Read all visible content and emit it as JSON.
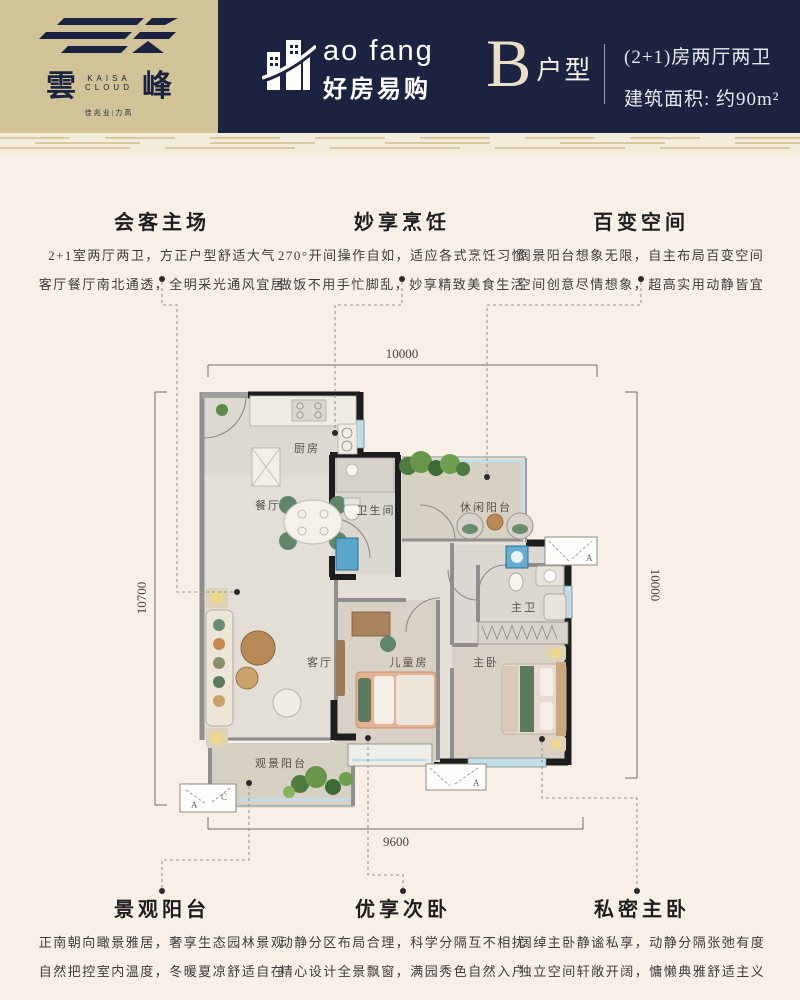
{
  "header": {
    "brand": {
      "hanzi_left": "雲",
      "hanzi_right": "峰",
      "en_top": "KAISA",
      "en_bottom": "CLOUD",
      "subtitle": "佳兆业|力高"
    },
    "platform": {
      "en": "ao fang",
      "zh": "好房易购"
    },
    "unit": {
      "letter": "B",
      "suffix": "户型"
    },
    "spec": {
      "line1": "(2+1)房两厅两卫",
      "line2": "建筑面积: 约90m²"
    }
  },
  "features_top": [
    {
      "title": "会客主场",
      "line1": "2+1室两厅两卫，方正户型舒适大气",
      "line2": "客厅餐厅南北通透，全明采光通风宜居"
    },
    {
      "title": "妙享烹饪",
      "line1": "270°开间操作自如，适应各式烹饪习惯",
      "line2": "做饭不用手忙脚乱，妙享精致美食生活"
    },
    {
      "title": "百变空间",
      "line1": "阔景阳台想象无限，自主布局百变空间",
      "line2": "空间创意尽情想象，超高实用动静皆宜"
    }
  ],
  "features_bottom": [
    {
      "title": "景观阳台",
      "line1": "正南朝向瞰景雅居，奢享生态园林景观",
      "line2": "自然把控室内温度，冬暖夏凉舒适自在"
    },
    {
      "title": "优享次卧",
      "line1": "动静分区布局合理，科学分隔互不相扰",
      "line2": "精心设计全景飘窗，满园秀色自然入户"
    },
    {
      "title": "私密主卧",
      "line1": "阔绰主卧静谧私享，动静分隔张弛有度",
      "line2": "独立空间轩敞开阔，慵懒典雅舒适主义"
    }
  ],
  "floorplan": {
    "dimensions": {
      "top": "10000",
      "left": "10700",
      "right": "10000",
      "bottom": "9600"
    },
    "rooms": {
      "kitchen": "厨房",
      "dining": "餐厅",
      "bathroom": "卫生间",
      "leisure_balcony": "休闲阳台",
      "master_bath": "主卫",
      "living": "客厅",
      "kids_room": "儿童房",
      "master_bedroom": "主卧",
      "view_balcony": "观景阳台"
    },
    "ac_units": {
      "a": "A",
      "c": "C"
    }
  },
  "colors": {
    "header_navy": "#1c2340",
    "brand_beige": "#d2c298",
    "page_cream": "#f8f0e7",
    "ornament_tan": "#dbcba4",
    "wall_black": "#1d1d1d",
    "window_blue": "#c3dde8"
  }
}
